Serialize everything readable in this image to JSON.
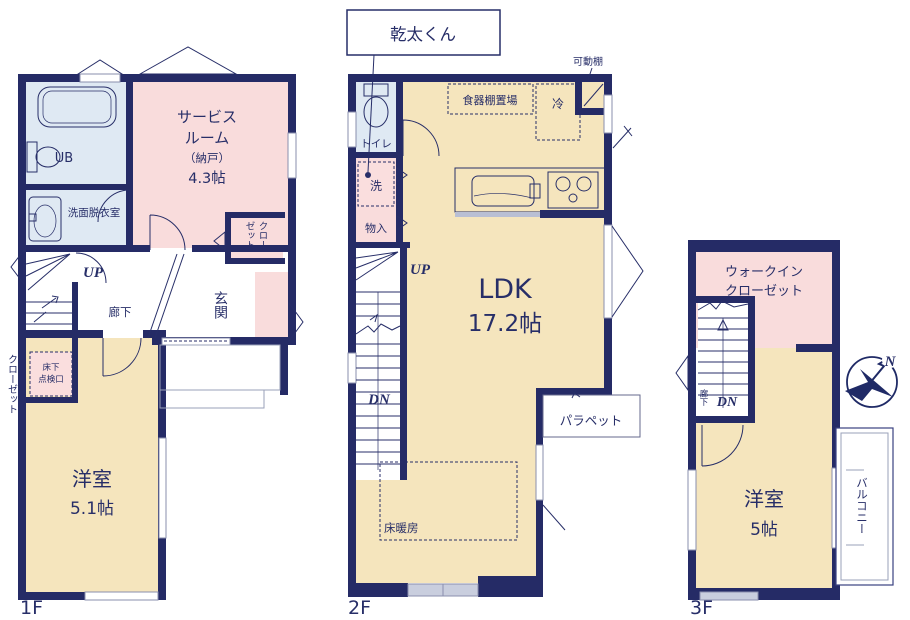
{
  "palette": {
    "wall": "#252b66",
    "room_cream": "#f5e5bd",
    "room_pink": "#f9dcdc",
    "room_blue": "#dfe9f3",
    "text_navy": "#272e68",
    "window_gray": "#c9cede"
  },
  "callout": {
    "label": "乾太くん"
  },
  "floor1": {
    "label": "1F",
    "bath": "UB",
    "washroom": "洗面脱衣室",
    "service_room": {
      "line1": "サービス",
      "line2": "ルーム",
      "line3": "（納戸）",
      "size": "4.3帖"
    },
    "closet": {
      "col1": "クロー",
      "col2": "ゼット"
    },
    "side_closet": "クローゼット",
    "hallway": "廊下",
    "entrance": "玄関",
    "stairs_up": "UP",
    "underfloor_hatch": {
      "line1": "床下",
      "line2": "点検口"
    },
    "bedroom": {
      "name": "洋室",
      "size": "5.1帖"
    }
  },
  "floor2": {
    "label": "2F",
    "toilet": "トイレ",
    "laundry": "洗",
    "storage": "物入",
    "cupboard_space": "食器棚置場",
    "fridge": "冷",
    "movable_shelf": "可動棚",
    "ldk": {
      "name": "LDK",
      "size": "17.2帖"
    },
    "stairs_up": "UP",
    "stairs_down": "DN",
    "parapet": "パラペット",
    "floor_heating": "床暖房"
  },
  "floor3": {
    "label": "3F",
    "wic": {
      "line1": "ウォークイン",
      "line2": "クローゼット"
    },
    "hallway": "廊下",
    "stairs_down": "DN",
    "bedroom": {
      "name": "洋室",
      "size": "5帖"
    },
    "balcony": "バルコニー",
    "compass_n": "N"
  }
}
